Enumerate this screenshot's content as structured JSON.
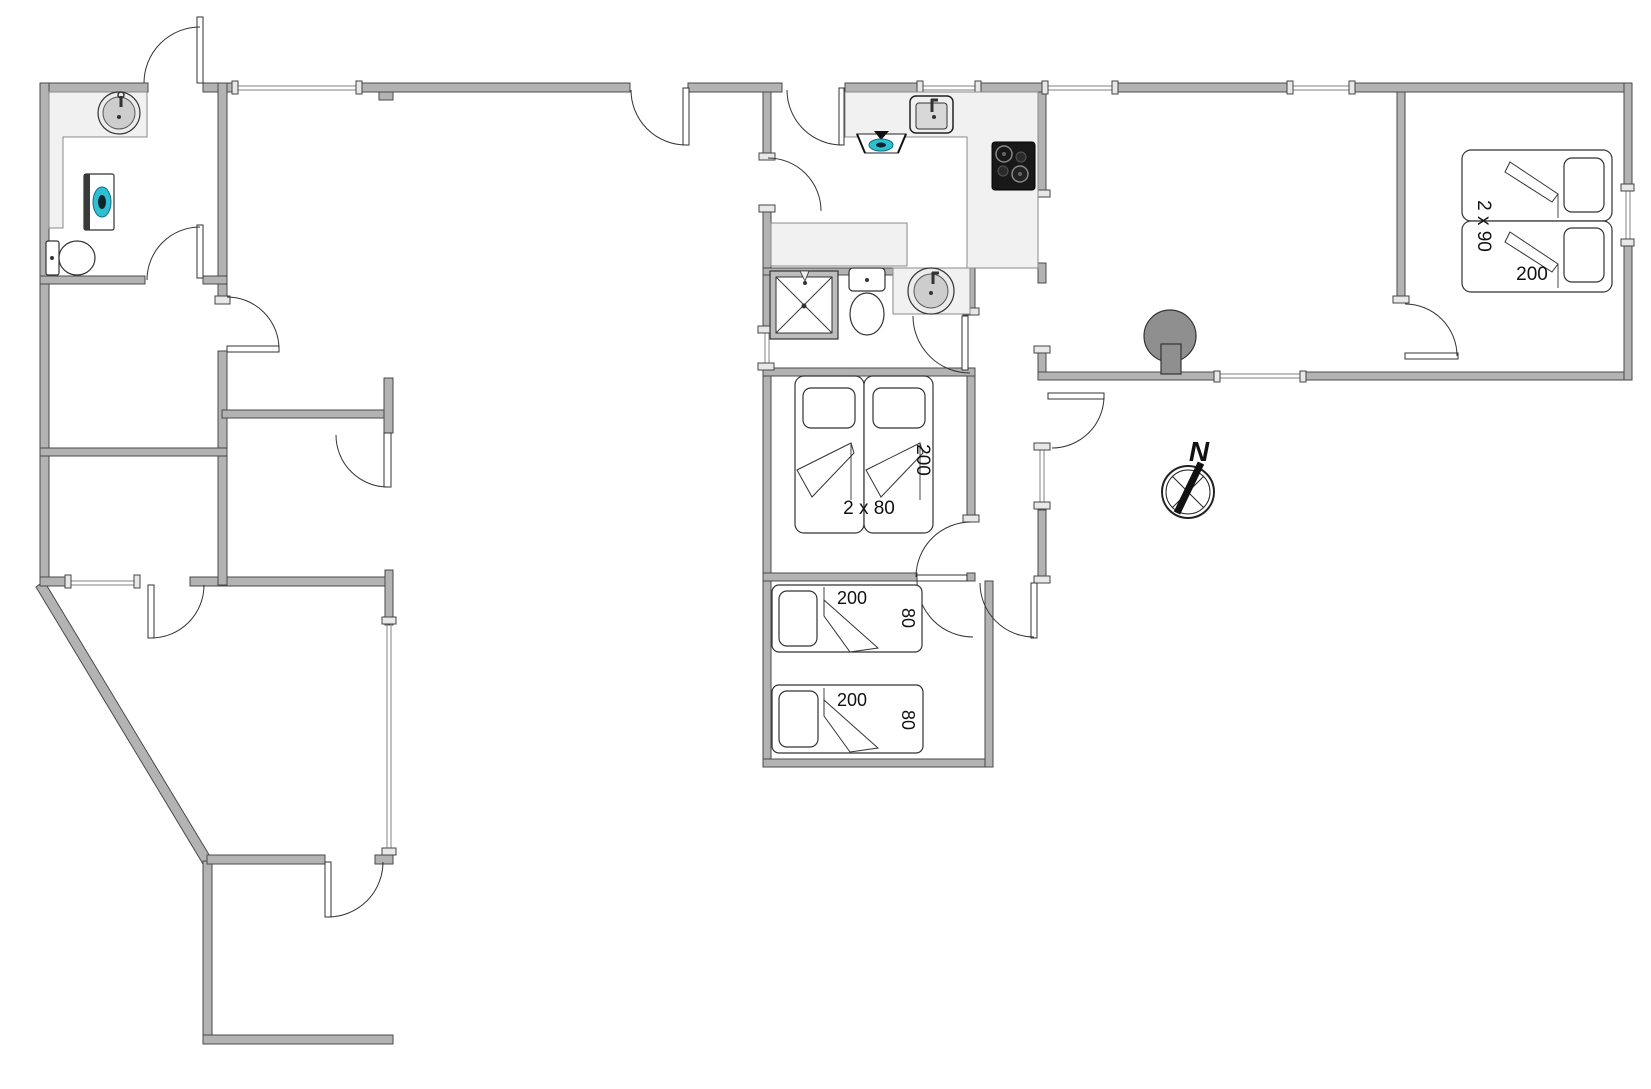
{
  "plan": {
    "title": "holiday-house-floor-plan",
    "compass_north": "N"
  },
  "labels": {
    "middle_double_bed": {
      "width": "2 x 80",
      "length": "200"
    },
    "single_bed_top": {
      "length": "200",
      "width": "80"
    },
    "single_bed_bottom": {
      "length": "200",
      "width": "80"
    },
    "right_double_bed": {
      "width": "2 x 90",
      "length": "200"
    }
  },
  "icons": {
    "compass-icon": "circle with N needle",
    "wood-stove-icon": "gray circle with flue",
    "shower-icon": "square with X",
    "toilet-icon": "tank and bowl",
    "round-sink-icon": "circle basin with faucet",
    "kitchen-sink-icon": "rounded rect basin with faucet",
    "stove-cooktop-icon": "black square with burners",
    "extractor-hood-icon": "trapezoid with teal fan",
    "washing-machine-icon": "box with teal drum",
    "bed-icon": "frame with pillow and folded blanket",
    "door-icon": "quarter-circle swing arc",
    "window-icon": "thin double line with end caps"
  },
  "colors": {
    "wall_fill": "#b3b3b3",
    "wall_outline": "#4a4a4a",
    "counter_fill": "#f1f1f1",
    "accent_teal": "#2ec0d2",
    "stove_black": "#181818",
    "fixture_gray": "#8f8f8f",
    "background": "#ffffff"
  }
}
